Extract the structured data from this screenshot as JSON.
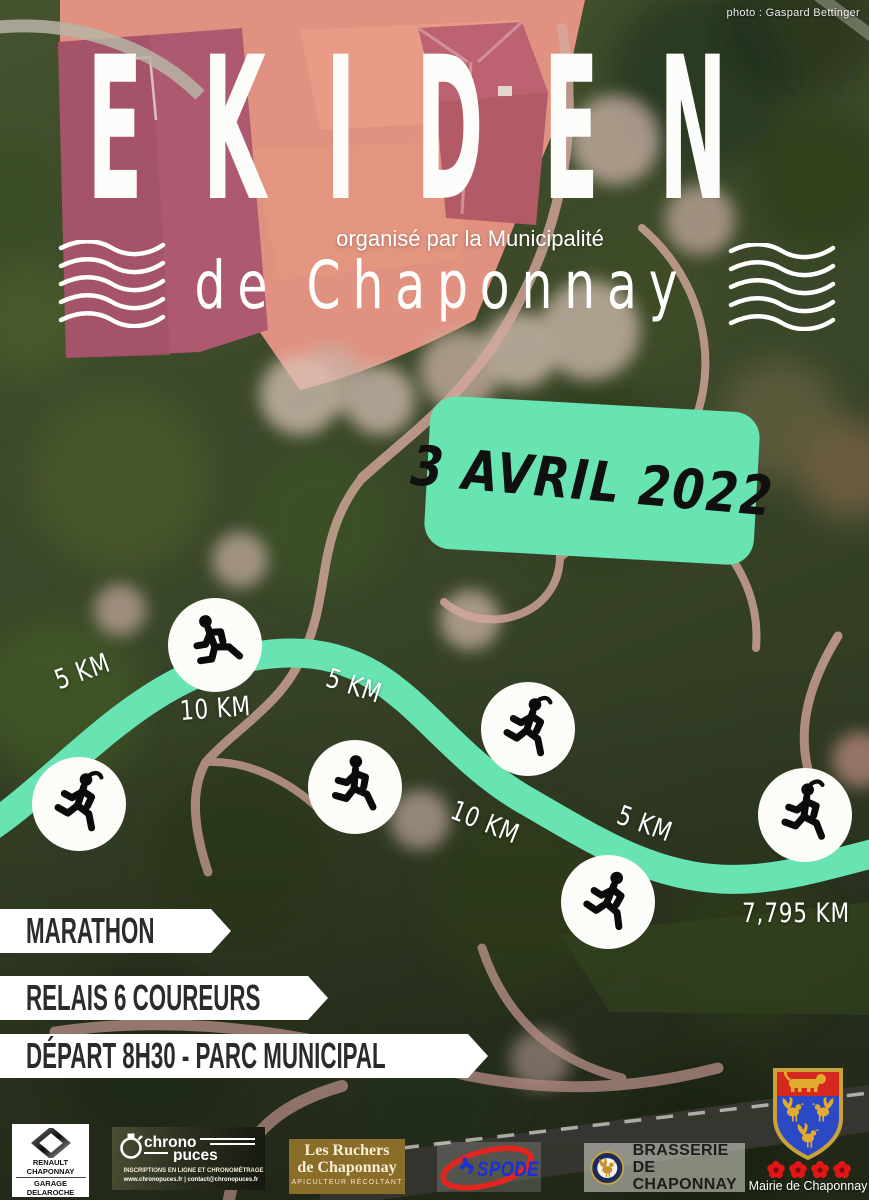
{
  "photo_credit": "photo : Gaspard Bettinger",
  "header": {
    "title": "EKIDEN",
    "organized_by": "organisé par la Municipalité",
    "subtitle": "de Chaponnay"
  },
  "date_badge": {
    "text": "3 AVRIL 2022"
  },
  "route": {
    "color": "#67e4b2",
    "labels": [
      {
        "text": "5 KM"
      },
      {
        "text": "10 KM"
      },
      {
        "text": "5 KM"
      },
      {
        "text": "10 KM"
      },
      {
        "text": "5 KM"
      },
      {
        "text": "7,795 KM"
      }
    ]
  },
  "banners": [
    {
      "label": "MARATHON"
    },
    {
      "label": "RELAIS 6 COUREURS"
    },
    {
      "label": "DÉPART 8H30 - PARC MUNICIPAL"
    }
  ],
  "sponsors": {
    "renault": {
      "line1": "RENAULT CHAPONNAY",
      "line2": "GARAGE DELAROCHE"
    },
    "chronopuces": {
      "word1": "chrono",
      "word2": "puces",
      "line1": "INSCRIPTIONS EN LIGNE ET CHRONOMÉTRAGE",
      "line2": "www.chronopuces.fr | contact@chronopuces.fr"
    },
    "ruchers": {
      "line1": "Les Ruchers",
      "line2": "de Chaponnay",
      "line3": "APICULTEUR RÉCOLTANT"
    },
    "spode": {
      "name": "SPODE"
    },
    "brasserie": {
      "line1": "BRASSERIE DE",
      "line2": "CHAPONNAY"
    },
    "mairie": {
      "caption": "Mairie de Chaponnay"
    }
  },
  "colors": {
    "accent_green": "#67e4b2",
    "banner_text": "#2b2b2b",
    "spode_red": "#e2261f",
    "spode_blue": "#1b2fd4",
    "ruchers_brown": "#8a6d28",
    "shield_blue": "#2b49c4",
    "shield_red": "#d6281e",
    "heraldic_gold": "#e2ab2e"
  }
}
